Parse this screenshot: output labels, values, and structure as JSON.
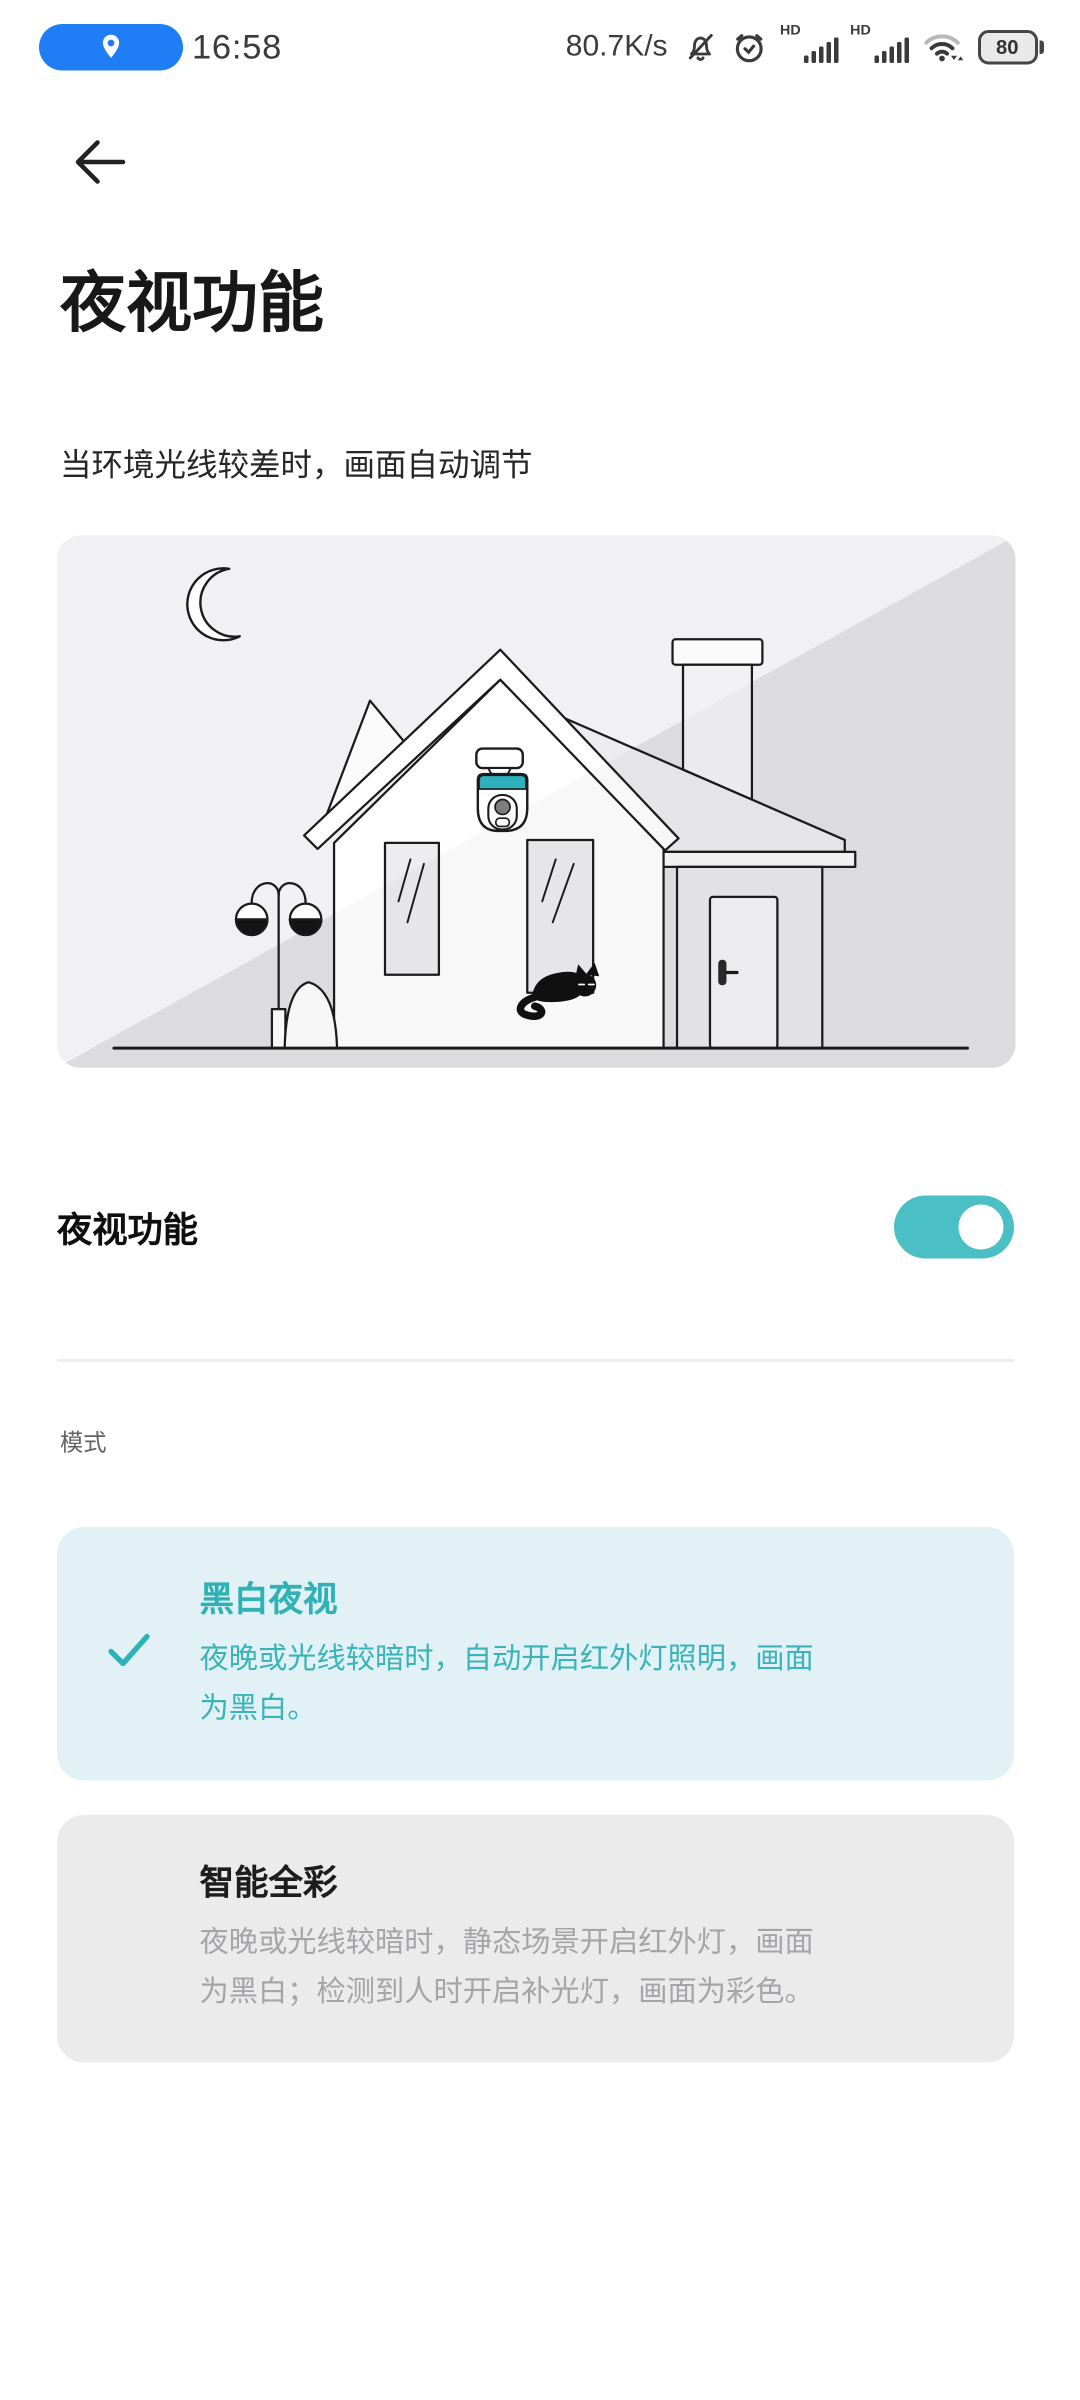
{
  "status_bar": {
    "time": "16:58",
    "net_speed": "80.7K/s",
    "sim1_label": "HD",
    "sim2_label": "HD",
    "battery_percent": "80",
    "icons": [
      "location-pill",
      "muted-bell",
      "alarm-clock",
      "sim1-signal",
      "sim2-signal",
      "wifi",
      "battery"
    ]
  },
  "header": {
    "title": "夜视功能",
    "subtitle": "当环境光线较差时，画面自动调节"
  },
  "illustration": {
    "content": "house-with-security-camera-moon-street-lamp-cat"
  },
  "toggle_row": {
    "label": "夜视功能",
    "enabled": true
  },
  "mode_section": {
    "label": "模式",
    "options": [
      {
        "title": "黑白夜视",
        "description": "夜晚或光线较暗时，自动开启红外灯照明，画面为黑白。",
        "selected": true
      },
      {
        "title": "智能全彩",
        "description": "夜晚或光线较暗时，静态场景开启红外灯，画面为黑白；检测到人时开启补光灯，画面为彩色。",
        "selected": false
      }
    ]
  },
  "colors": {
    "accent_teal": "#2eb2b6",
    "toggle_on": "#4ac0c4",
    "selected_card_bg": "#e2f1f5",
    "unselected_card_bg": "#ebebec",
    "status_pill_blue": "#1f7ef6",
    "camera_band": "#2fb0bd"
  }
}
